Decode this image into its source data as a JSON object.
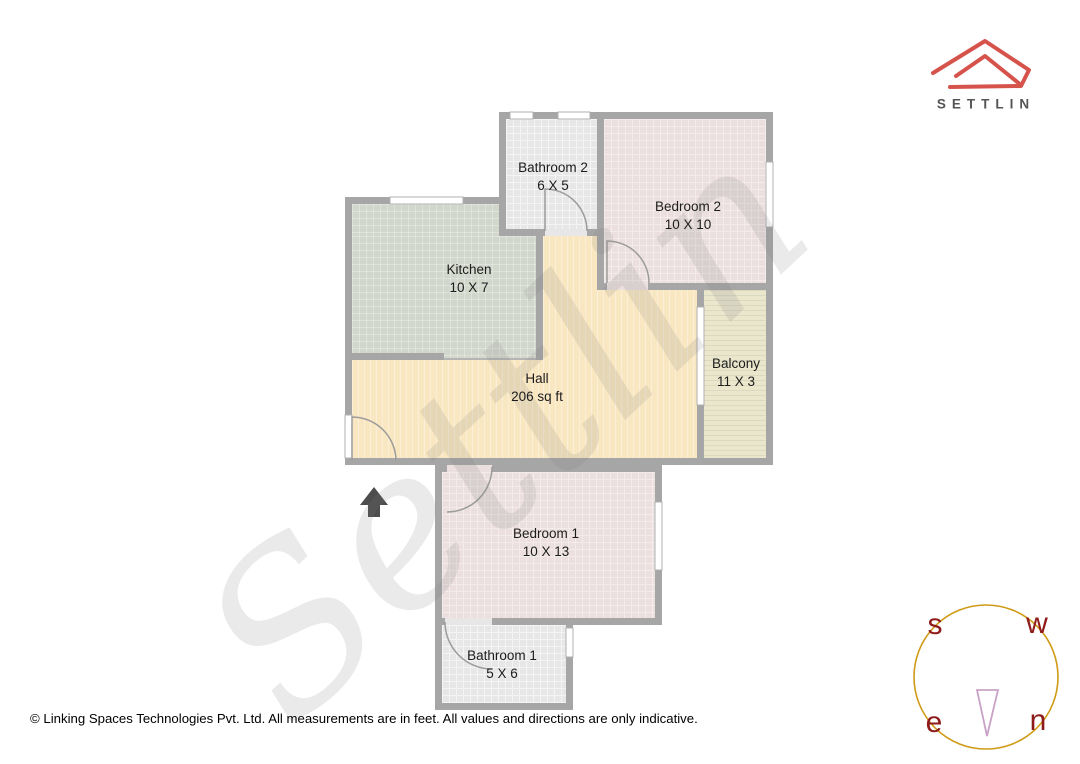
{
  "header": {
    "logo_text": "SETTLIN"
  },
  "watermark": {
    "text": "Settlin"
  },
  "floorplan": {
    "rooms": [
      {
        "name": "Bathroom 2",
        "dims": "6 X 5"
      },
      {
        "name": "Bedroom 2",
        "dims": "10 X 10"
      },
      {
        "name": "Kitchen",
        "dims": "10 X 7"
      },
      {
        "name": "Hall",
        "dims": "206 sq ft"
      },
      {
        "name": "Balcony",
        "dims": "11 X 3"
      },
      {
        "name": "Bedroom 1",
        "dims": "10 X 13"
      },
      {
        "name": "Bathroom 1",
        "dims": "5 X 6"
      }
    ]
  },
  "compass": {
    "south": "s",
    "west": "w",
    "east": "e",
    "north": "n"
  },
  "footer": {
    "copyright": "© Linking Spaces Technologies Pvt. Ltd. All measurements are in feet. All values and directions are only indicative."
  },
  "colors": {
    "logo_red": "#d5534b",
    "wall_gray": "#a6a6a6",
    "hall": "#f9e7c2",
    "bedroom": "#ecdfdf",
    "kitchen": "#d2d7cc",
    "bathroom": "#e7e7e7",
    "balcony": "#eae7cd",
    "compass_circle": "#cf9b16",
    "compass_letters": "#8f1a1a",
    "needle": "#c9a2c7",
    "entrance_arrow": "#4d4d4d"
  }
}
